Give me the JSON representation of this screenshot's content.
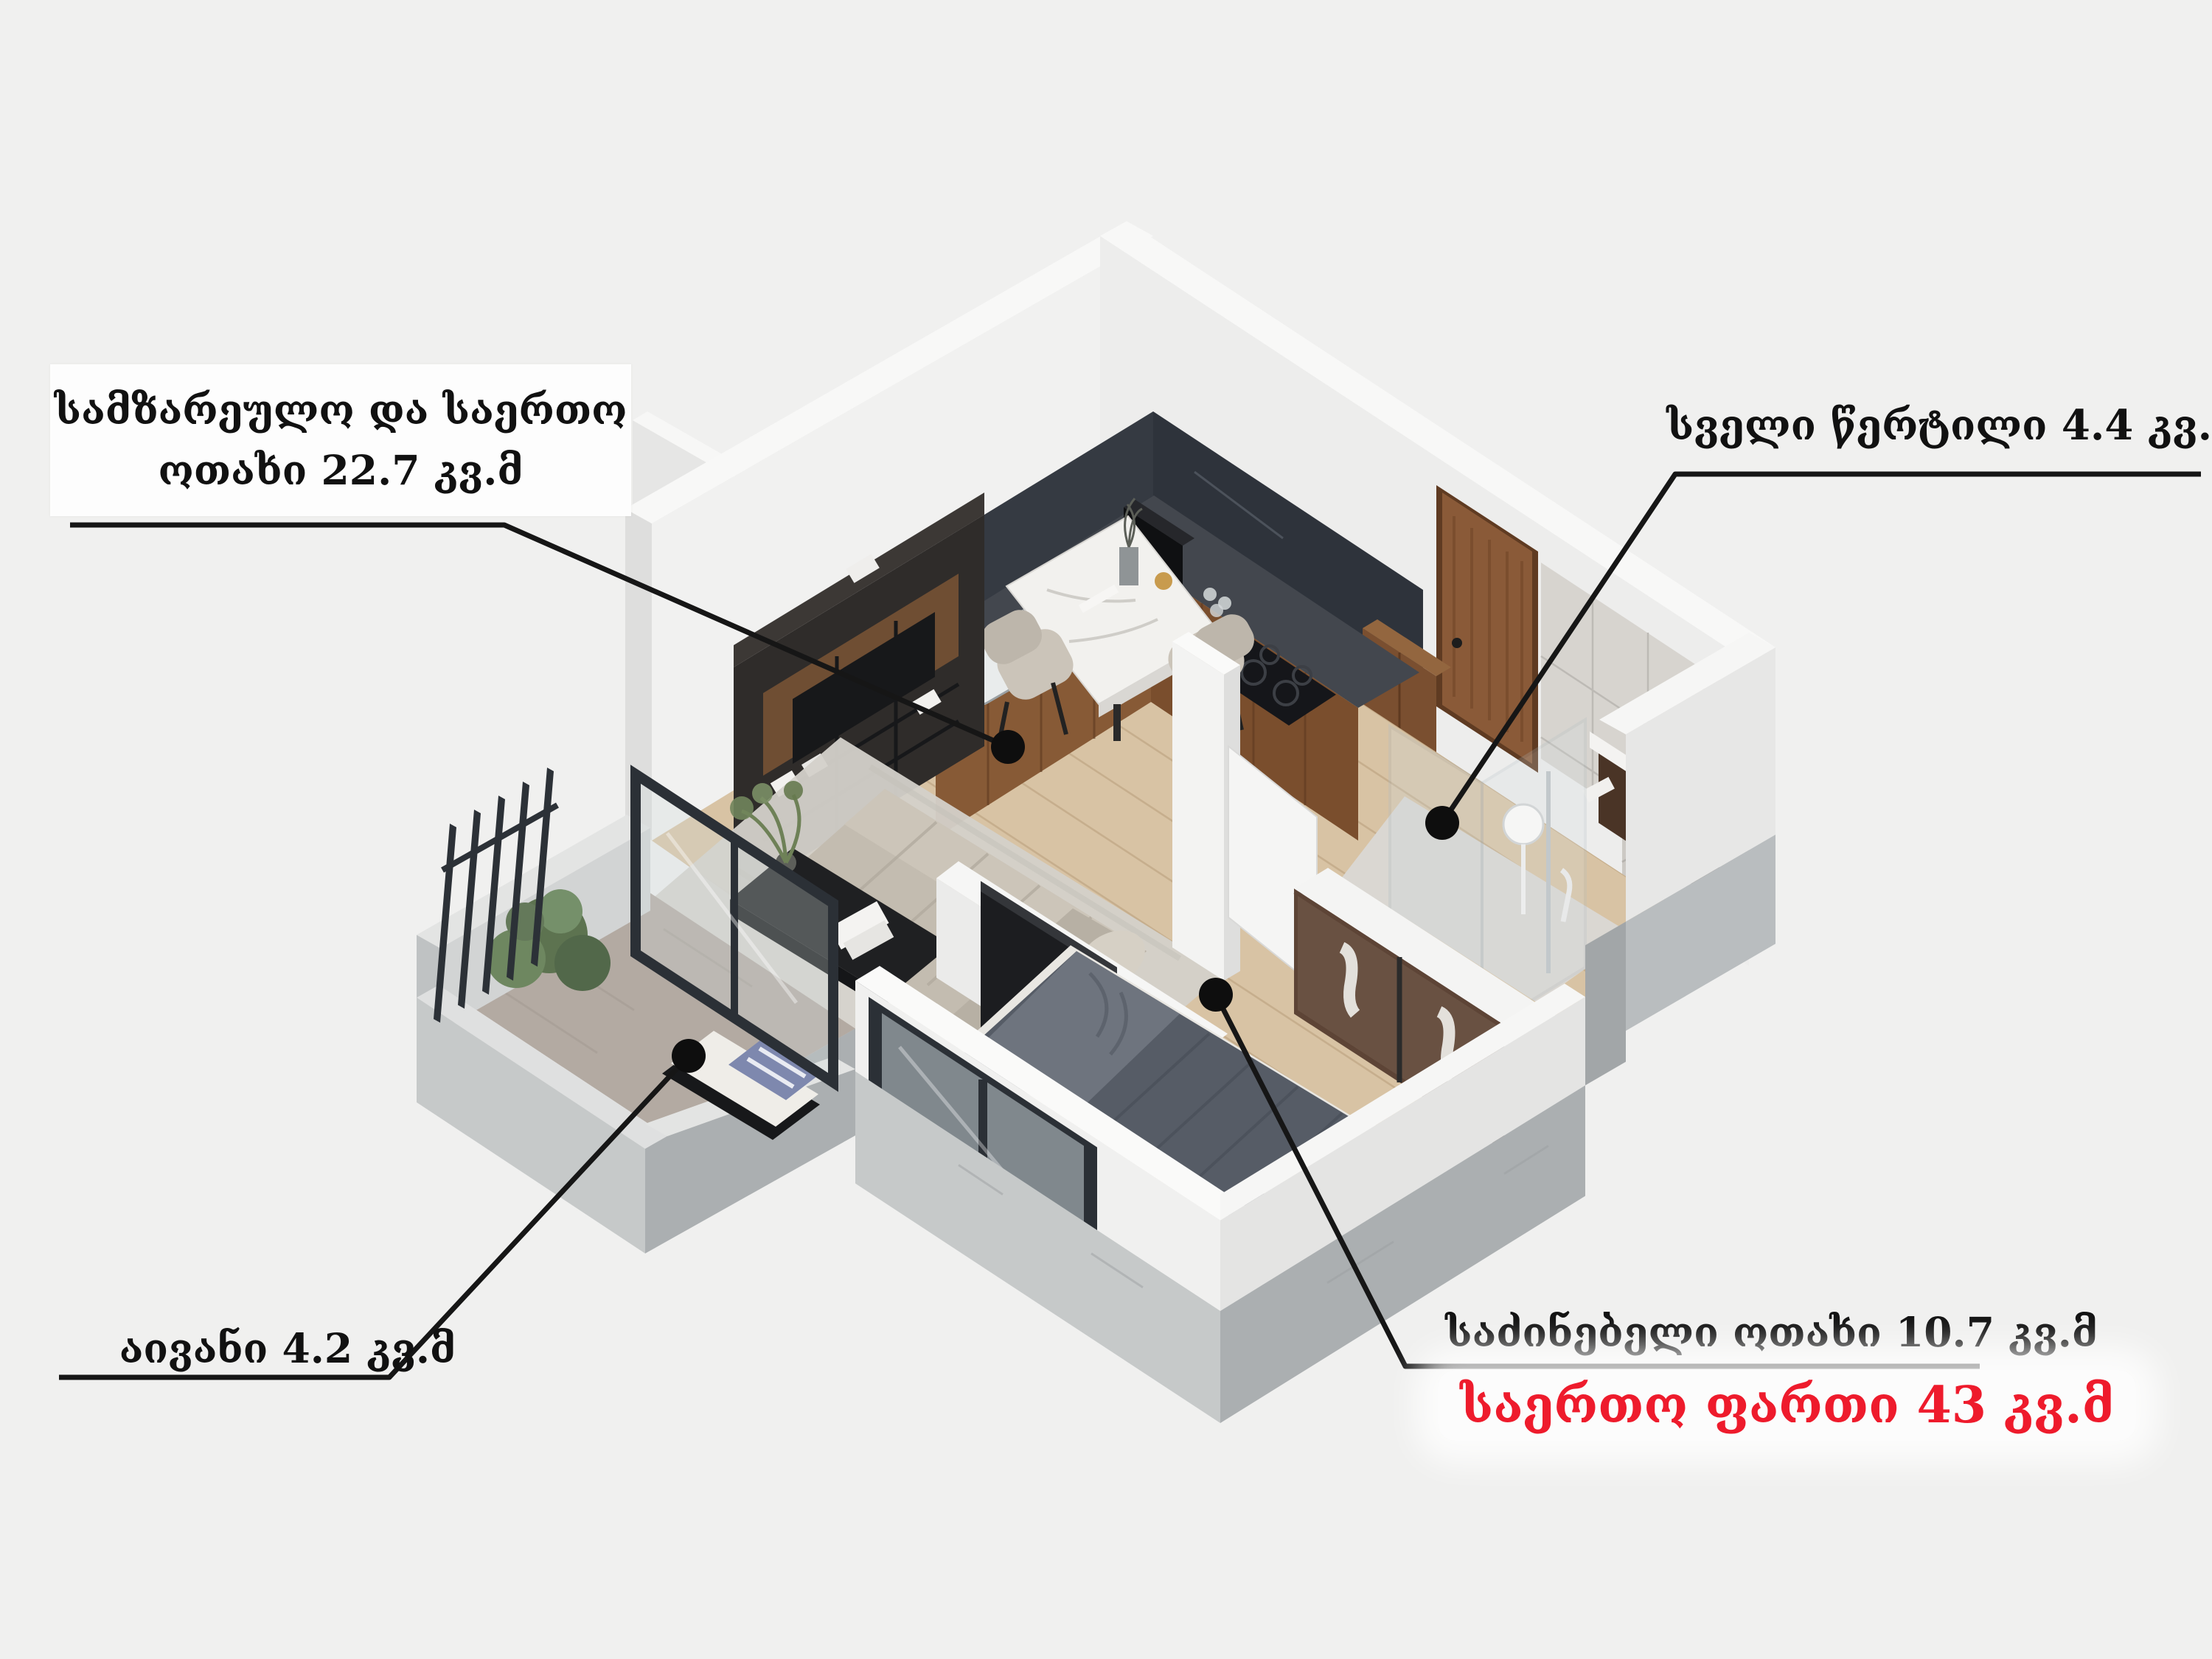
{
  "poster": {
    "type": "isometric-floorplan-render",
    "language": "ka",
    "unit": "კვ.მ"
  },
  "labels": {
    "living": {
      "line1": "სამზარეულო და საერთო",
      "line2": "ოთახი 22.7  კვ.მ"
    },
    "wet": {
      "text": "სველი წერტილი  4.4 კვ.მ"
    },
    "balcony": {
      "text": "აივანი 4.2 კვ.მ"
    },
    "bedroom": {
      "text": "საძინებელი ოთახი 10.7 კვ.მ"
    },
    "total": {
      "text": "საერთო ფართი 43 კვ.მ"
    }
  },
  "rooms": [
    {
      "id": "living-kitchen",
      "name": "სამზარეულო და საერთო ოთახი",
      "area": 22.7,
      "unit": "კვ.მ"
    },
    {
      "id": "wet-point",
      "name": "სველი წერტილი",
      "area": 4.4,
      "unit": "კვ.მ"
    },
    {
      "id": "balcony",
      "name": "აივანი",
      "area": 4.2,
      "unit": "კვ.მ"
    },
    {
      "id": "bedroom",
      "name": "საძინებელი ოთახი",
      "area": 10.7,
      "unit": "კვ.მ"
    }
  ],
  "total_area": {
    "name": "საერთო ფართი",
    "area": 43,
    "unit": "კვ.მ"
  },
  "colors": {
    "background": "#f0f0ef",
    "label_box": "#fdfdfd",
    "text": "#111111",
    "accent_red": "#ee1b2c",
    "leader_line": "#161616",
    "wood_floor": "#d8c3a4",
    "concrete": "#b3b7b9",
    "counter_dark": "#43474e",
    "cabinet_walnut": "#8a5c39"
  }
}
